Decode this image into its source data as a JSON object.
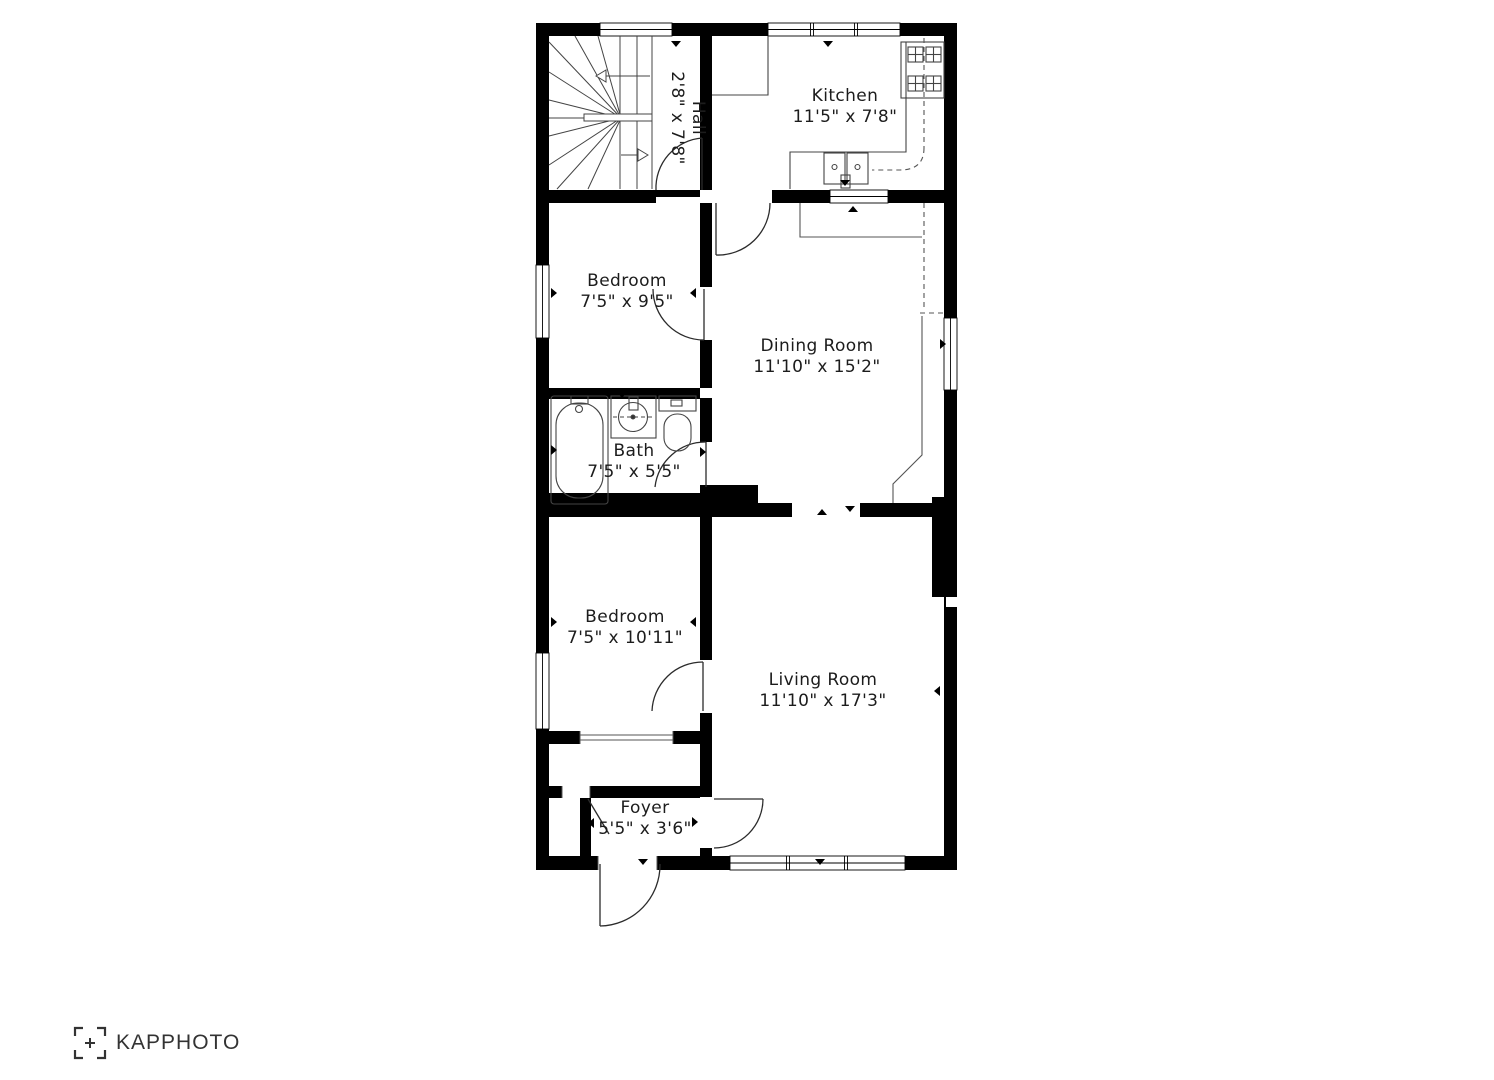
{
  "meta": {
    "background_color": "#ffffff",
    "wall_color": "#000000",
    "line_color": "#3f3f3f",
    "text_color": "#1c1c1c",
    "logo_color": "#333333"
  },
  "rooms": [
    {
      "id": "hall",
      "name": "Hall",
      "dims": "2'8\" x 7'8\""
    },
    {
      "id": "kitchen",
      "name": "Kitchen",
      "dims": "11'5\" x 7'8\""
    },
    {
      "id": "bedroom1",
      "name": "Bedroom",
      "dims": "7'5\" x 9'5\""
    },
    {
      "id": "dining",
      "name": "Dining Room",
      "dims": "11'10\" x 15'2\""
    },
    {
      "id": "bath",
      "name": "Bath",
      "dims": "7'5\" x 5'5\""
    },
    {
      "id": "bedroom2",
      "name": "Bedroom",
      "dims": "7'5\" x 10'11\""
    },
    {
      "id": "living",
      "name": "Living Room",
      "dims": "11'10\" x 17'3\""
    },
    {
      "id": "foyer",
      "name": "Foyer",
      "dims": "5'5\" x 3'6\""
    }
  ],
  "fixtures": [
    "winder-staircase",
    "stove-4-burner",
    "kitchen-double-sink",
    "bathtub",
    "vanity-sink",
    "toilet"
  ],
  "branding": {
    "logo_text": "KAPPHOTO"
  }
}
